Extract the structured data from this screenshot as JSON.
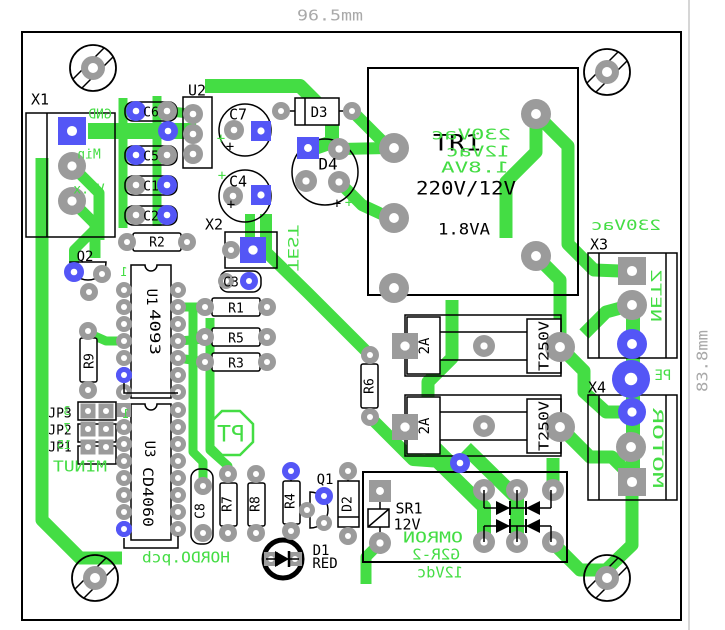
{
  "meta": {
    "board_file_label": "HORDO.pcb",
    "width_dimension": "96.5mm",
    "height_dimension": "83.8mm"
  },
  "colors": {
    "background": "#ffffff",
    "copper_trace": "#44dd44",
    "silkscreen_green": "#44dd44",
    "silkscreen_black": "#000000",
    "pad_gray": "#9b9b9b",
    "pad_blue": "#5456f6",
    "dimension_gray": "#a9a9a9",
    "outline_black": "#000000"
  },
  "labels": [
    {
      "name": "refdes-x1",
      "text": "X1",
      "x": 40,
      "y": 99,
      "size": 15
    },
    {
      "name": "refdes-u2",
      "text": "U2",
      "x": 197,
      "y": 90,
      "size": 15
    },
    {
      "name": "refdes-c6",
      "text": "C6",
      "x": 151,
      "y": 112,
      "size": 13
    },
    {
      "name": "refdes-c5",
      "text": "C5",
      "x": 151,
      "y": 156,
      "size": 13
    },
    {
      "name": "refdes-c1",
      "text": "C1",
      "x": 151,
      "y": 186,
      "size": 13
    },
    {
      "name": "refdes-c2",
      "text": "C2",
      "x": 151,
      "y": 216,
      "size": 13
    },
    {
      "name": "refdes-c7",
      "text": "C7",
      "x": 238,
      "y": 114,
      "size": 15
    },
    {
      "name": "refdes-c4",
      "text": "C4",
      "x": 238,
      "y": 181,
      "size": 15
    },
    {
      "name": "refdes-d3",
      "text": "D3",
      "x": 319,
      "y": 112,
      "size": 14
    },
    {
      "name": "refdes-d4",
      "text": "D4",
      "x": 328,
      "y": 164,
      "size": 16
    },
    {
      "name": "refdes-x2",
      "text": "X2",
      "x": 214,
      "y": 224,
      "size": 15
    },
    {
      "name": "refdes-tr1",
      "text": "TR1",
      "x": 457,
      "y": 143,
      "size": 22,
      "w": 48
    },
    {
      "name": "tr1-ratio",
      "text": "220V/12V",
      "x": 466,
      "y": 188,
      "size": 19,
      "w": 100
    },
    {
      "name": "tr1-power",
      "text": "1.8VA",
      "x": 464,
      "y": 229,
      "size": 16,
      "w": 52
    },
    {
      "name": "refdes-r2",
      "text": "R2",
      "x": 157,
      "y": 242,
      "size": 13
    },
    {
      "name": "refdes-q2",
      "text": "Q2",
      "x": 85,
      "y": 256,
      "size": 14
    },
    {
      "name": "refdes-u1",
      "text": "U1",
      "x": 152,
      "y": 297,
      "size": 14,
      "rot": 90
    },
    {
      "name": "u1-value",
      "text": "4093",
      "x": 155,
      "y": 332,
      "size": 14,
      "rot": 90,
      "w": 46
    },
    {
      "name": "refdes-r1",
      "text": "R1",
      "x": 236,
      "y": 308,
      "size": 13
    },
    {
      "name": "refdes-r5",
      "text": "R5",
      "x": 236,
      "y": 338,
      "size": 13
    },
    {
      "name": "refdes-r3",
      "text": "R3",
      "x": 236,
      "y": 363,
      "size": 13
    },
    {
      "name": "refdes-r9",
      "text": "R9",
      "x": 89,
      "y": 361,
      "size": 13,
      "rot": -90
    },
    {
      "name": "refdes-c3",
      "text": "C3",
      "x": 231,
      "y": 282,
      "size": 13
    },
    {
      "name": "refdes-r6",
      "text": "R6",
      "x": 369,
      "y": 386,
      "size": 13,
      "rot": -90
    },
    {
      "name": "refdes-jp3",
      "text": "JP3",
      "x": 60,
      "y": 413,
      "size": 13
    },
    {
      "name": "refdes-jp2",
      "text": "JP2",
      "x": 60,
      "y": 430,
      "size": 13
    },
    {
      "name": "refdes-jp1",
      "text": "JP1",
      "x": 60,
      "y": 447,
      "size": 13
    },
    {
      "name": "refdes-u3",
      "text": "U3",
      "x": 150,
      "y": 449,
      "size": 14,
      "rot": 90
    },
    {
      "name": "u3-value",
      "text": "CD4060",
      "x": 148,
      "y": 497,
      "size": 14,
      "rot": 90,
      "w": 60
    },
    {
      "name": "refdes-c8",
      "text": "C8",
      "x": 200,
      "y": 511,
      "size": 13,
      "rot": -90
    },
    {
      "name": "refdes-r7",
      "text": "R7",
      "x": 227,
      "y": 504,
      "size": 13,
      "rot": -90
    },
    {
      "name": "refdes-r8",
      "text": "R8",
      "x": 255,
      "y": 504,
      "size": 13,
      "rot": -90
    },
    {
      "name": "refdes-r4",
      "text": "R4",
      "x": 290,
      "y": 501,
      "size": 13,
      "rot": -90
    },
    {
      "name": "refdes-q1",
      "text": "Q1",
      "x": 325,
      "y": 479,
      "size": 14
    },
    {
      "name": "refdes-d2",
      "text": "D2",
      "x": 347,
      "y": 504,
      "size": 13,
      "rot": -90
    },
    {
      "name": "refdes-d1",
      "text": "D1",
      "x": 321,
      "y": 550,
      "size": 14
    },
    {
      "name": "d1-color",
      "text": "RED",
      "x": 325,
      "y": 563,
      "size": 14
    },
    {
      "name": "refdes-sr1",
      "text": "SR1",
      "x": 409,
      "y": 508,
      "size": 15
    },
    {
      "name": "sr1-voltage",
      "text": "12V",
      "x": 407,
      "y": 524,
      "size": 15
    },
    {
      "name": "refdes-x3",
      "text": "X3",
      "x": 599,
      "y": 244,
      "size": 15
    },
    {
      "name": "refdes-x4",
      "text": "X4",
      "x": 597,
      "y": 387,
      "size": 15
    },
    {
      "name": "fuse1-rating",
      "text": "2A",
      "x": 424,
      "y": 346,
      "size": 14,
      "rot": -90
    },
    {
      "name": "fuse1-voltage",
      "text": "T250V",
      "x": 544,
      "y": 346,
      "size": 13,
      "rot": -90,
      "w": 50
    },
    {
      "name": "fuse2-rating",
      "text": "2A",
      "x": 424,
      "y": 426,
      "size": 14,
      "rot": -90
    },
    {
      "name": "fuse2-voltage",
      "text": "T250V",
      "x": 544,
      "y": 426,
      "size": 13,
      "rot": -90,
      "w": 50
    },
    {
      "name": "c7-polarity-plus",
      "text": "+",
      "x": 230,
      "y": 146,
      "size": 14
    },
    {
      "name": "c4-polarity-plus",
      "text": "+",
      "x": 231,
      "y": 204,
      "size": 14
    },
    {
      "name": "d4-polarity-plus",
      "text": "+",
      "x": 337,
      "y": 203,
      "size": 14
    },
    {
      "name": "x1-pin-gnd",
      "text": "GND",
      "x": 100,
      "y": 114,
      "size": 13,
      "color": "green",
      "mirror": true
    },
    {
      "name": "x1-pin-min",
      "text": "Min",
      "x": 89,
      "y": 154,
      "size": 13,
      "color": "green",
      "mirror": true
    },
    {
      "name": "x1-pin-vox",
      "text": "Vo.x",
      "x": 89,
      "y": 189,
      "size": 13,
      "color": "green",
      "mirror": true
    },
    {
      "name": "u1-pin1-marker",
      "text": "1",
      "x": 124,
      "y": 272,
      "size": 12,
      "color": "green",
      "mirror": true
    },
    {
      "name": "test-label",
      "text": "TEST",
      "x": 293,
      "y": 248,
      "size": 14,
      "color": "green",
      "rot": 90,
      "mirror": true,
      "w": 46
    },
    {
      "name": "tr1-primary-voltage",
      "text": "230Vac",
      "x": 471,
      "y": 134,
      "size": 15,
      "color": "green",
      "mirror": true,
      "w": 80
    },
    {
      "name": "tr1-secondary-voltage",
      "text": "12Vac",
      "x": 478,
      "y": 151,
      "size": 15,
      "color": "green",
      "mirror": true,
      "w": 64
    },
    {
      "name": "tr1-va-green",
      "text": "1.8VA",
      "x": 475,
      "y": 167,
      "size": 15,
      "color": "green",
      "mirror": true,
      "w": 68
    },
    {
      "name": "jp3-pin-number",
      "text": "3",
      "x": 67,
      "y": 411,
      "size": 12,
      "color": "green",
      "mirror": true
    },
    {
      "name": "jp2-pin-number",
      "text": "7",
      "x": 67,
      "y": 428,
      "size": 12,
      "color": "green",
      "mirror": true
    },
    {
      "name": "jp1-pin-number",
      "text": "15",
      "x": 64,
      "y": 445,
      "size": 12,
      "color": "green",
      "mirror": true
    },
    {
      "name": "u3-pin1-marker",
      "text": "1",
      "x": 126,
      "y": 414,
      "size": 12,
      "color": "green",
      "mirror": true
    },
    {
      "name": "minut-label",
      "text": "MINUT",
      "x": 80,
      "y": 466,
      "size": 15,
      "color": "green",
      "mirror": true,
      "w": 54
    },
    {
      "name": "pt-logo-text",
      "text": "PT",
      "x": 231,
      "y": 434,
      "size": 22,
      "color": "green",
      "mirror": true,
      "w": 28
    },
    {
      "name": "board-name",
      "text": "HORDO.pcb",
      "x": 186,
      "y": 557,
      "size": 15,
      "color": "green",
      "mirror": true,
      "w": 88
    },
    {
      "name": "relay-brand",
      "text": "OMRON",
      "x": 433,
      "y": 537,
      "size": 15,
      "color": "green",
      "mirror": true,
      "w": 60
    },
    {
      "name": "relay-model",
      "text": "G2R-2",
      "x": 436,
      "y": 554,
      "size": 15,
      "color": "green",
      "mirror": true,
      "w": 48
    },
    {
      "name": "relay-coil-voltage",
      "text": "12Vdc",
      "x": 440,
      "y": 572,
      "size": 15,
      "color": "green",
      "mirror": true,
      "w": 46
    },
    {
      "name": "x3-voltage",
      "text": "230Vac",
      "x": 626,
      "y": 225,
      "size": 14,
      "color": "green",
      "mirror": true,
      "w": 70
    },
    {
      "name": "x3-net",
      "text": "NETZ",
      "x": 656,
      "y": 296,
      "size": 14,
      "color": "green",
      "rot": 90,
      "mirror": true,
      "w": 52
    },
    {
      "name": "pe-label",
      "text": "PE",
      "x": 663,
      "y": 375,
      "size": 14,
      "color": "green",
      "mirror": true
    },
    {
      "name": "x4-net",
      "text": "MOTOR",
      "x": 658,
      "y": 448,
      "size": 14,
      "color": "green",
      "rot": 90,
      "mirror": true,
      "w": 80
    },
    {
      "name": "c7-plus-green",
      "text": "+",
      "x": 221,
      "y": 138,
      "size": 14,
      "color": "green"
    },
    {
      "name": "c4-plus-green",
      "text": "+",
      "x": 222,
      "y": 175,
      "size": 14,
      "color": "green"
    },
    {
      "name": "d4-plus-green",
      "text": "+",
      "x": 349,
      "y": 202,
      "size": 14,
      "color": "green"
    },
    {
      "name": "dim-width",
      "text": "96.5mm",
      "x": 330,
      "y": 15,
      "size": 15,
      "color": "gray",
      "w": 66
    },
    {
      "name": "dim-height",
      "text": "83.8mm",
      "x": 702,
      "y": 361,
      "size": 15,
      "color": "gray",
      "rot": -90,
      "w": 62
    }
  ]
}
